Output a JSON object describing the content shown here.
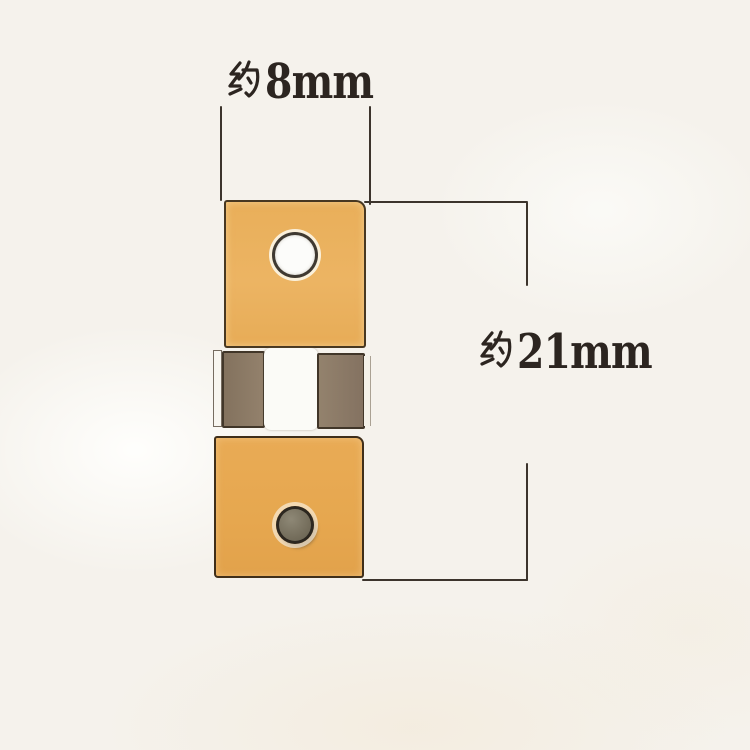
{
  "background_color": "#f5f2ec",
  "annotations": {
    "line_color": "#3c342c",
    "text_color": "#2c2520",
    "width": {
      "label": "约8mm",
      "prefix": "约",
      "value": "8mm"
    },
    "height": {
      "label": "约21mm",
      "prefix": "约",
      "value": "21mm"
    }
  },
  "part": {
    "top_block": {
      "color": "#eab15d",
      "outline_color": "#2c2318",
      "hole_color": "#fcfcfa"
    },
    "middle": {
      "left_block_color": "#8b7963",
      "center_strip_color": "#fbfbf7",
      "right_block_color": "#8c7b67",
      "edge_highlight_color": "#f8f6f0"
    },
    "bottom_block": {
      "color": "#e6a751",
      "outline_color": "#281e12",
      "rivet_color": "#746d5b"
    }
  }
}
